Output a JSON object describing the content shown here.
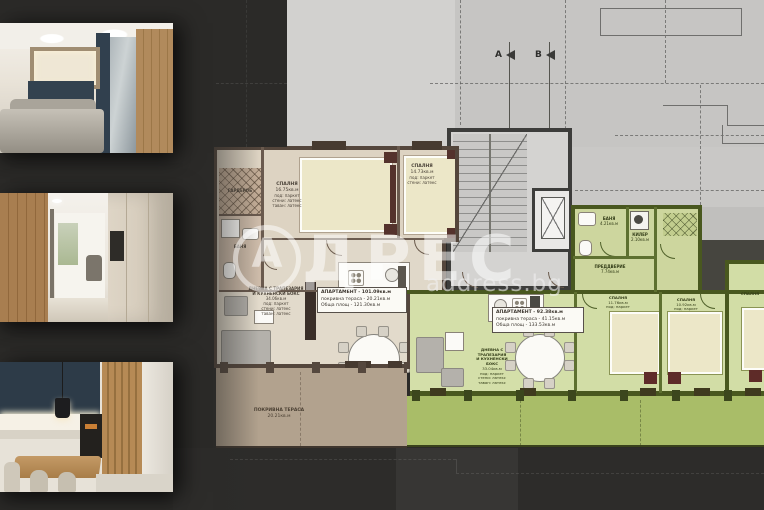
{
  "colors": {
    "background": "#2b2a28",
    "apartment_beige_floor": "#ddd3c2",
    "apartment_green_floor": "#d2dda6",
    "terrace_beige": "#b2a28e",
    "terrace_green": "#a9bd68",
    "watermark": "#ffffff"
  },
  "watermark": {
    "logo_letter": "А",
    "word": "ДРЕС",
    "site": "address.bg"
  },
  "sections": {
    "a": "A",
    "b": "B"
  },
  "apartments": {
    "beige": {
      "info": {
        "l1": "АПАРТАМЕНТ - 101.09кв.м",
        "l2": "покривна тераса - 20.21кв.м",
        "l3": "Обща площ - 121.30кв.м"
      },
      "rooms": {
        "bedroom1": {
          "name": "СПАЛНЯ",
          "area": "16.75кв.м",
          "f1": "под: паркет",
          "f2": "стени: латекс",
          "f3": "таван: латекс"
        },
        "bedroom2": {
          "name": "СПАЛНЯ",
          "area": "14.73кв.м",
          "f1": "под: паркет",
          "f2": "стени: латекс"
        },
        "bathroom": {
          "name": "БАНЯ"
        },
        "wardrobe": {
          "name": "ГАРДЕРОБ"
        },
        "living": {
          "l1": "ДНЕВНА С ТРАПЕЗАРИЯ",
          "l2": "И КУХНЕНСКИ БОКС",
          "area": "34.06кв.м",
          "f1": "под: паркет",
          "f2": "стени: латекс",
          "f3": "таван: латекс"
        },
        "terrace": {
          "name": "ПОКРИВНА ТЕРАСА",
          "area": "20.21кв.м"
        }
      }
    },
    "green": {
      "info": {
        "l1": "АПАРТАМЕНТ - 92.38кв.м",
        "l2": "покривна тераса - 41.15кв.м",
        "l3": "Обща площ - 133.53кв.м"
      },
      "rooms": {
        "bathroom": {
          "name": "БАНЯ",
          "area": "4.21кв.м"
        },
        "closet": {
          "name": "КИЛЕР",
          "area": "2.10кв.м"
        },
        "hall": {
          "name": "ПРЕДДВЕРИЕ",
          "area": "7.74кв.м"
        },
        "living": {
          "l1": "ДНЕВНА С ТРАПЕЗАРИЯ",
          "l2": "И КУХНЕНСКИ БОКС",
          "area": "33.04кв.м",
          "f1": "под: паркет",
          "f2": "стени: латекс",
          "f3": "таван: латекс"
        },
        "bedroom1": {
          "name": "СПАЛНЯ",
          "area": "11.76кв.м",
          "f1": "под: паркет",
          "f2": "стени: латекс",
          "f3": "таван: латекс"
        },
        "bedroom2": {
          "name": "СПАЛНЯ",
          "area": "10.92кв.м",
          "f1": "под: паркет",
          "f2": "стени: латекс"
        },
        "bedroom3": {
          "name": "СПАЛНЯ"
        }
      }
    }
  }
}
